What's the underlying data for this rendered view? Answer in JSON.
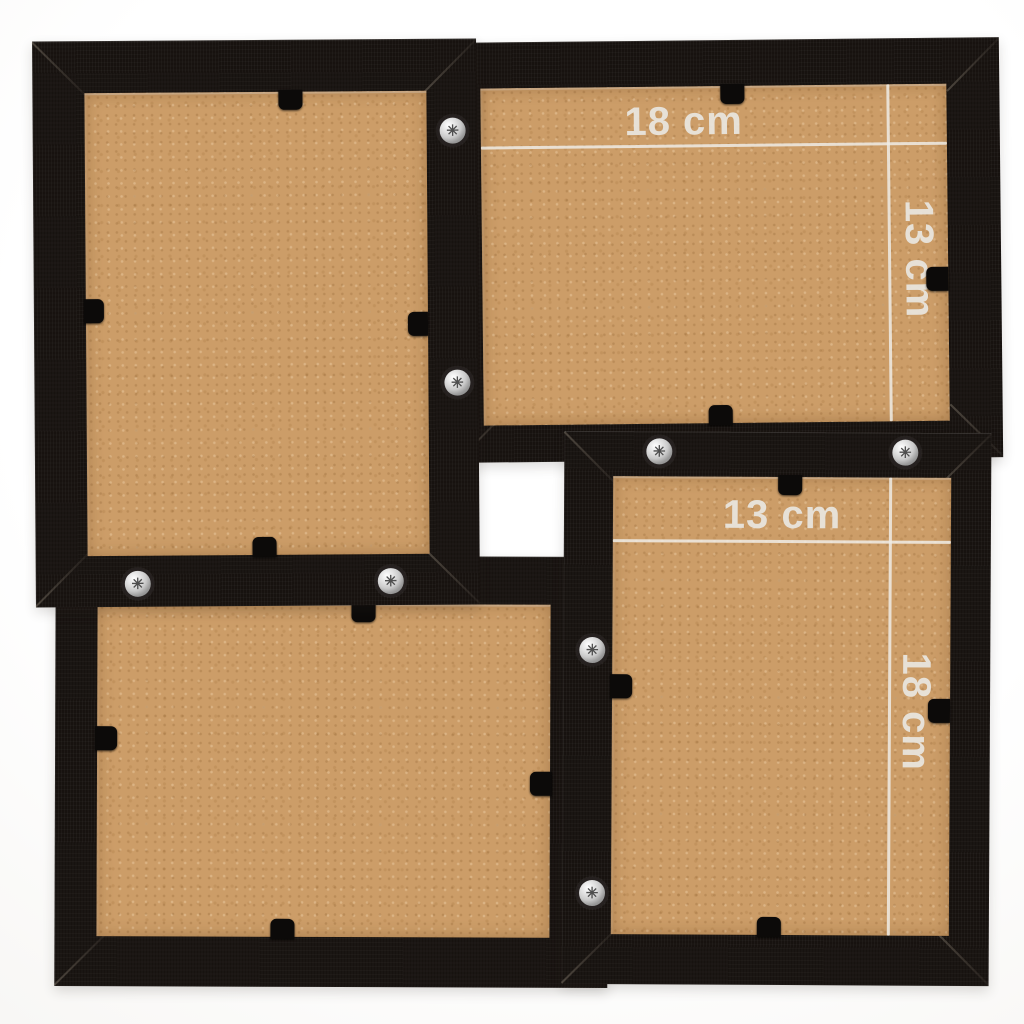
{
  "product": {
    "colors": {
      "frame": "#17120f",
      "backing": "#cc9d68",
      "background": "#f2f1ef",
      "dimension_line": "#efece6",
      "dimension_label": "#eae7e1",
      "screw": "#c9c9c9"
    },
    "screw_glyph": "✳"
  },
  "annotations": {
    "top_right_frame": {
      "width_label": "18 cm",
      "height_label": "13 cm"
    },
    "bottom_right_frame": {
      "width_label": "13 cm",
      "height_label": "18 cm"
    }
  }
}
